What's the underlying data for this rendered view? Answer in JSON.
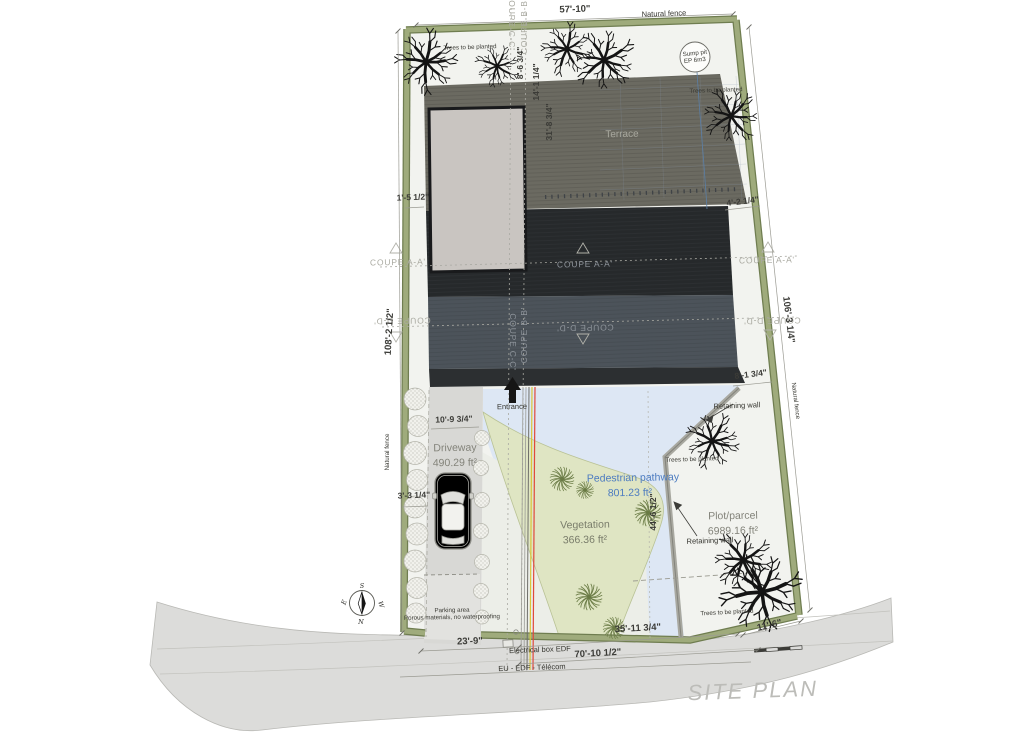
{
  "title": "SITE PLAN",
  "dims": {
    "top_width": "57'-10\"",
    "left_height": "108'-2 1/2\"",
    "right_height": "106'-3 1/4\"",
    "terrace_offset_a": "8'-6 3/4\"",
    "terrace_offset_b": "14'-1 1/4\"",
    "terrace_depth": "31'-8 3/4\"",
    "fence_gap": "1'-5 1/2\"",
    "terrace_right": "4'-2 1/4\"",
    "roof_right": "8'-1 3/4\"",
    "driveway_width": "10'-9 3/4\"",
    "driveway_side": "3'-3 1/4\"",
    "parcel_height": "44'-6 1/2\"",
    "bottom_left": "23'-9\"",
    "bottom_mid": "35'-11 3/4\"",
    "bottom_right": "11'-6\"",
    "bottom_total": "70'-10 1/2\""
  },
  "sections": {
    "aa": "COUPE A-A'",
    "bb": "COUPE B-B'",
    "cc": "COUPE C-C'",
    "dd": "COUPE D-D'"
  },
  "areas": {
    "driveway_name": "Driveway",
    "driveway_area": "490.29 ft²",
    "vegetation_name": "Vegetation",
    "vegetation_area": "366.36 ft²",
    "pathway_name": "Pedestrian pathway",
    "pathway_area": "801.23 ft²",
    "plot_name": "Plot/parcel",
    "plot_area": "6989.16 ft²"
  },
  "features": {
    "natural_fence": "Natural fence",
    "trees_planted": "Trees to be planted",
    "sump_pit_1": "Sump pit",
    "sump_pit_2": "EP 6m3",
    "terrace": "Terrace",
    "entrance": "Entrance",
    "retaining_wall": "Retaining wall",
    "parking_1": "Parking area",
    "parking_2": "Porous materials, no waterproofing",
    "electrical": "Electrical box EDF",
    "utilities": "EU - EDF - Télécom"
  },
  "compass": {
    "n": "N",
    "s": "S",
    "e": "E",
    "w": "W"
  },
  "colors": {
    "fence": "#8f9c6d",
    "fence_edge": "#6f7d50",
    "road": "#dcdcda",
    "ground": "#f2f3ef",
    "terrace_roof": "#6b6a61",
    "dark_roof": "#26292b",
    "slate_roof": "#4c535a",
    "skylight": "#c9c5c1",
    "driveway": "#d8d8d5",
    "pathway": "#dde7f4",
    "vegetation": "#dfe5c3",
    "label_blue": "#4d7cc0"
  }
}
